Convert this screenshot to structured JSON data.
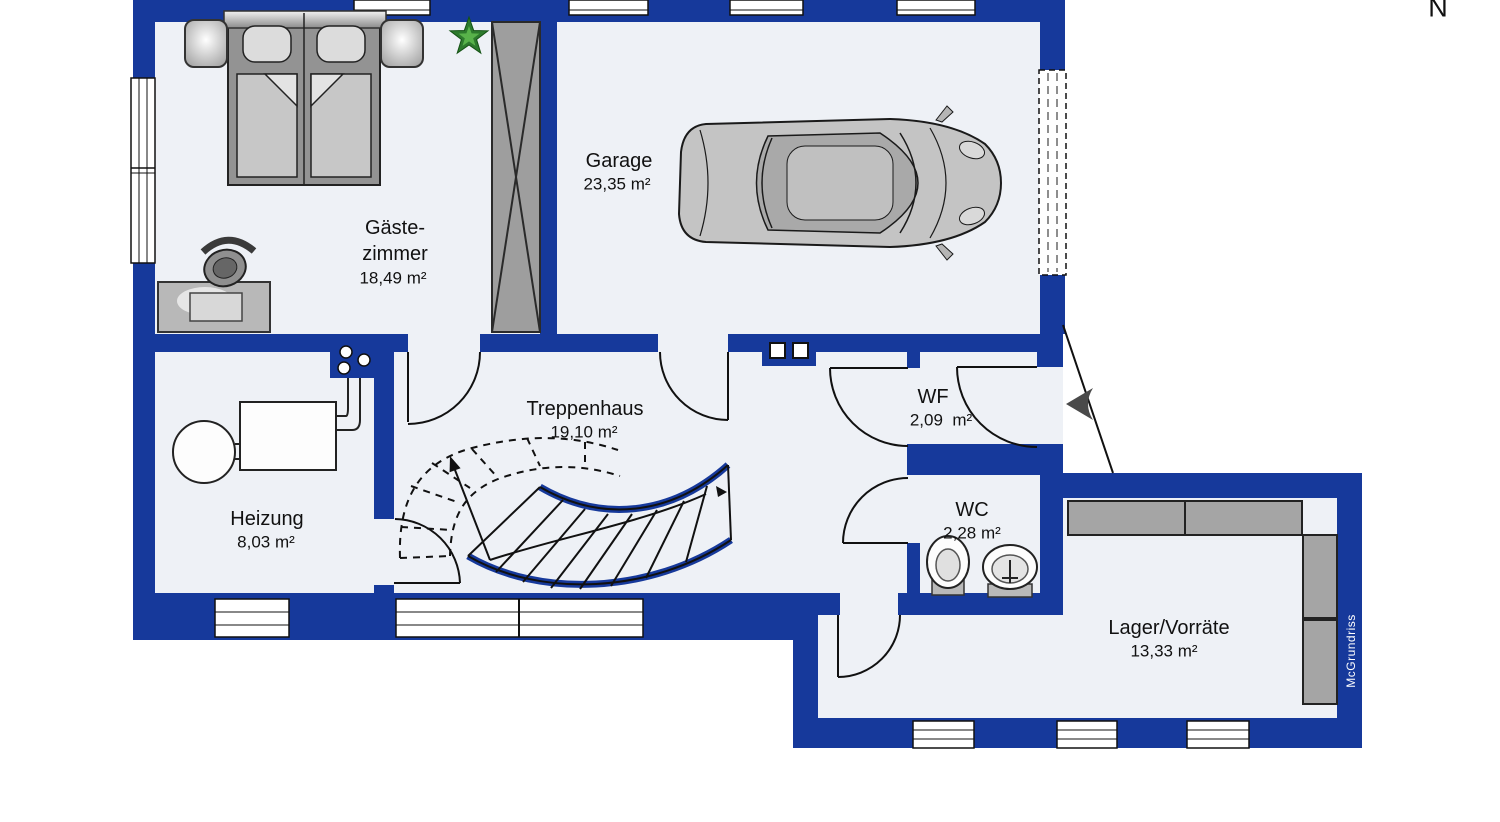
{
  "meta": {
    "north_label": "N",
    "watermark": "McGrundriss"
  },
  "colors": {
    "wall_blue": "#16399B",
    "floor": "#EEF1F6",
    "furniture_gray": "#A5A5A5",
    "outline": "#1A1A1A"
  },
  "rooms": {
    "gaestezimmer": {
      "name_line1": "Gäste-",
      "name_line2": "zimmer",
      "area": "18,49 m²"
    },
    "garage": {
      "name": "Garage",
      "area": "23,35 m²"
    },
    "treppenhaus": {
      "name": "Treppenhaus",
      "area": "19,10 m²"
    },
    "heizung": {
      "name": "Heizung",
      "area": "8,03 m²"
    },
    "wf": {
      "name": "WF",
      "area": "2,09  m²"
    },
    "wc": {
      "name": "WC",
      "area": "2,28 m²"
    },
    "lager": {
      "name": "Lager/Vorräte",
      "area": "13,33 m²"
    }
  }
}
